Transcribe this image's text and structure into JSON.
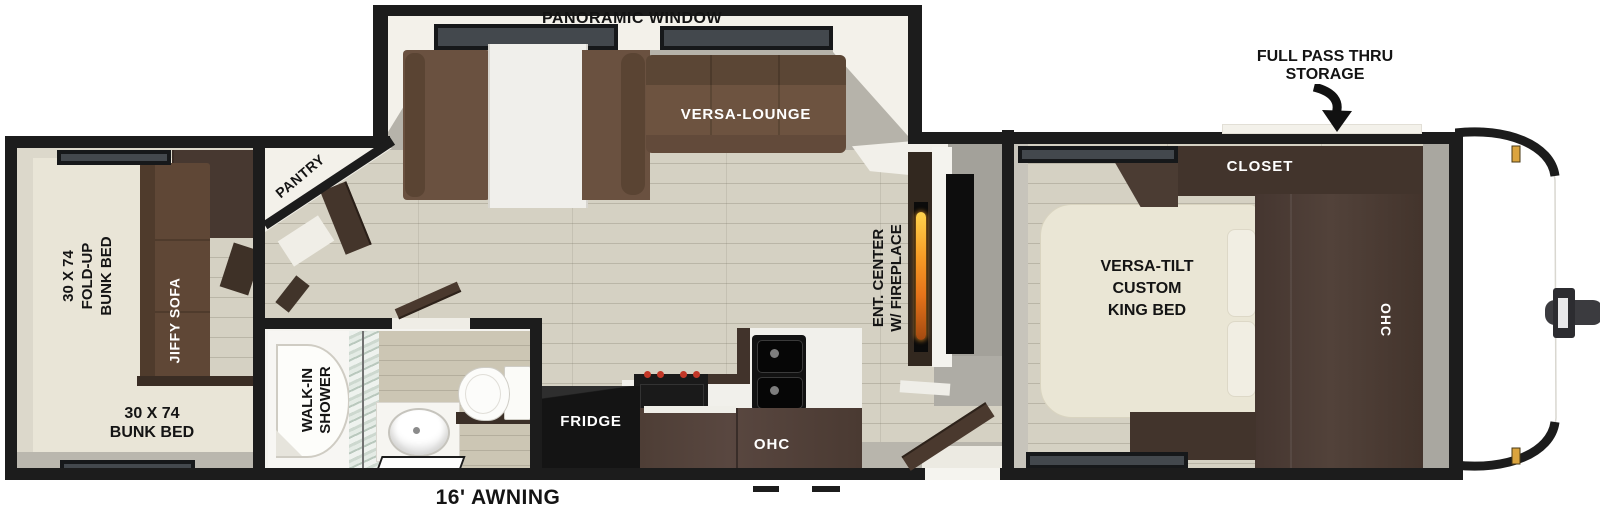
{
  "floorplan": {
    "title": "Travel trailer floor plan",
    "slideout": {
      "window_label": "PANORAMIC WINDOW",
      "lounge_label": "VERSA-LOUNGE"
    },
    "storage": {
      "line1": "FULL PASS THRU",
      "line2": "STORAGE"
    },
    "bedroom": {
      "closet_label": "CLOSET",
      "ohc_label": "OHC",
      "bed_line1": "VERSA-TILT",
      "bed_line2": "CUSTOM",
      "bed_line3": "KING BED"
    },
    "living": {
      "ent_line1": "ENT. CENTER",
      "ent_line2": "W/ FIREPLACE",
      "pantry_label": "PANTRY"
    },
    "kitchen": {
      "fridge_label": "FRIDGE",
      "ohc_label": "OHC"
    },
    "bathroom": {
      "shower_line1": "WALK-IN",
      "shower_line2": "SHOWER"
    },
    "bunkroom": {
      "foldup_line1": "30 X 74",
      "foldup_line2": "FOLD-UP",
      "foldup_line3": "BUNK BED",
      "sofa_label": "JIFFY SOFA",
      "bunk_line1": "30 X 74",
      "bunk_line2": "BUNK BED"
    },
    "exterior": {
      "awning_label": "16' AWNING"
    },
    "colors": {
      "wall": "#1c1c1c",
      "wood_floor": "#d5d1c3",
      "cabinet_dark": "#47382f",
      "sofa_brown": "#6a5140",
      "bed_cream": "#eae6d5",
      "flame_accent": "#f1901f",
      "marker_light": "#dba43e"
    }
  }
}
